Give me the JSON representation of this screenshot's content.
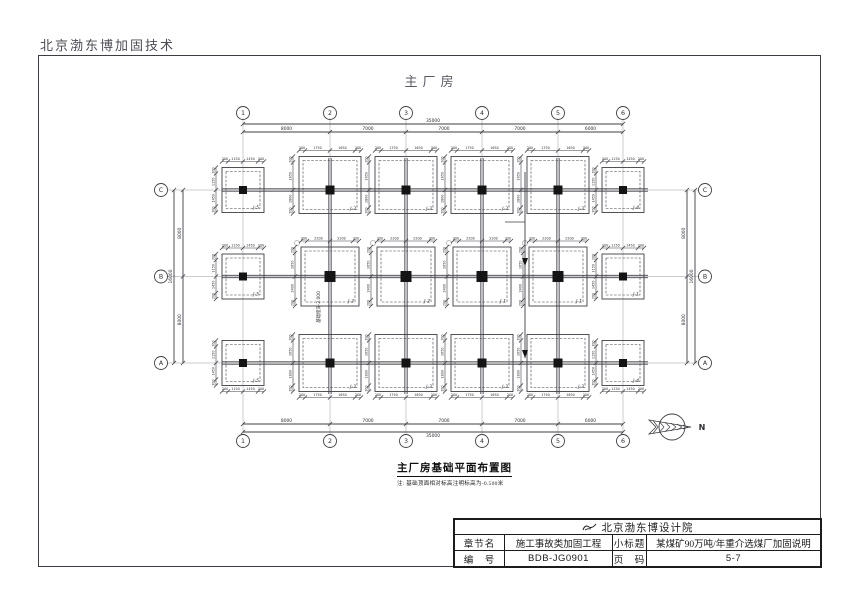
{
  "header": {
    "company": "北京渤东博加固技术"
  },
  "drawing": {
    "sheet_title": "主厂房",
    "caption_title": "主厂房基础平面布置图",
    "caption_note": "注: 基础顶面相对标高注明标高为-0.500米",
    "north_label": "N",
    "depth_annotation": "基础埋深-2.000"
  },
  "grid": {
    "col_labels": [
      "1",
      "2",
      "3",
      "4",
      "5",
      "6"
    ],
    "col_spacings": [
      "8000",
      "7000",
      "7000",
      "7000",
      "6000"
    ],
    "col_total": "35000",
    "row_labels": [
      "C",
      "B",
      "A"
    ],
    "row_spacings": [
      "8000",
      "8000"
    ],
    "row_total": "16000"
  },
  "footing_types": {
    "main_top": {
      "h_dims": [
        "200",
        "1750",
        "1650",
        "200"
      ],
      "v_dims": [
        "200",
        "1650",
        "1800",
        "200"
      ]
    },
    "main_mid": {
      "h_dims": [
        "200",
        "2200",
        "2200",
        "200"
      ],
      "v_dims": [
        "200",
        "1650",
        "2400",
        "200"
      ]
    },
    "side": {
      "h_dims": [
        "200",
        "1150",
        "1450",
        "200"
      ],
      "v_dims": [
        "200",
        "1150",
        "1450",
        "200"
      ]
    }
  },
  "footings": [
    {
      "col": 0,
      "row": 0,
      "label": "J-5",
      "type": "side"
    },
    {
      "col": 0,
      "row": 1,
      "label": "J-5",
      "type": "side"
    },
    {
      "col": 0,
      "row": 2,
      "label": "J-5",
      "type": "side"
    },
    {
      "col": 1,
      "row": 0,
      "label": "J-3",
      "type": "main_top"
    },
    {
      "col": 2,
      "row": 0,
      "label": "J-3",
      "type": "main_top"
    },
    {
      "col": 3,
      "row": 0,
      "label": "J-3",
      "type": "main_top"
    },
    {
      "col": 4,
      "row": 0,
      "label": "J-3",
      "type": "main_top"
    },
    {
      "col": 5,
      "row": 0,
      "label": "J-4",
      "type": "side"
    },
    {
      "col": 1,
      "row": 1,
      "label": "J-2",
      "type": "main_mid"
    },
    {
      "col": 2,
      "row": 1,
      "label": "J-2",
      "type": "main_mid"
    },
    {
      "col": 3,
      "row": 1,
      "label": "J-1",
      "type": "main_mid"
    },
    {
      "col": 4,
      "row": 1,
      "label": "J-1",
      "type": "main_mid"
    },
    {
      "col": 5,
      "row": 1,
      "label": "J-1",
      "type": "side"
    },
    {
      "col": 1,
      "row": 2,
      "label": "J-3",
      "type": "main_top"
    },
    {
      "col": 2,
      "row": 2,
      "label": "J-3",
      "type": "main_top"
    },
    {
      "col": 3,
      "row": 2,
      "label": "J-3",
      "type": "main_top"
    },
    {
      "col": 4,
      "row": 2,
      "label": "J-3",
      "type": "main_top"
    },
    {
      "col": 5,
      "row": 2,
      "label": "J-4",
      "type": "side"
    }
  ],
  "title_block": {
    "institute": "北京渤东博设计院",
    "rows": [
      {
        "k1": "章节名",
        "v1": "施工事故类加固工程",
        "k2": "小标题",
        "v2": "某煤矿90万吨/年重介选煤厂加固说明"
      },
      {
        "k1": "编　号",
        "v1": "BDB-JG0901",
        "k2": "页　码",
        "v2": "5-7"
      }
    ]
  }
}
